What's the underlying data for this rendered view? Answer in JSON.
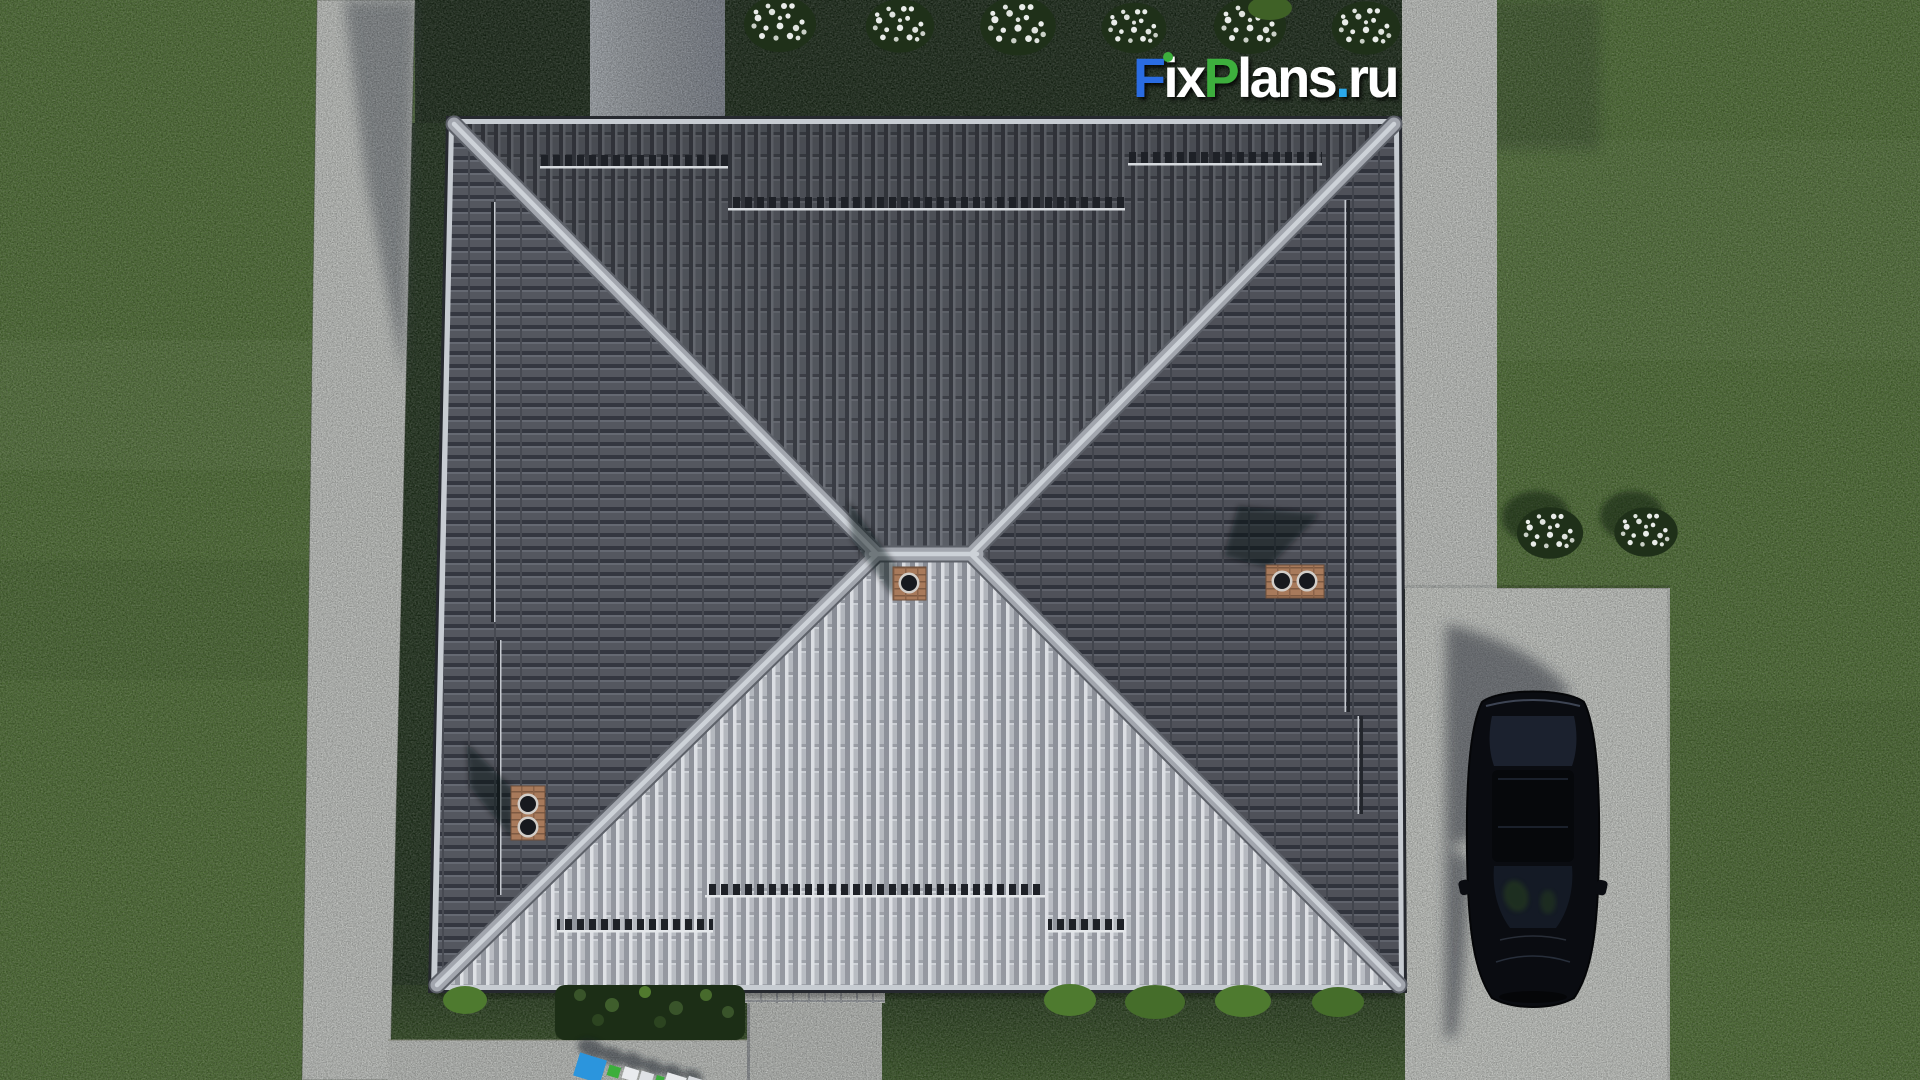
{
  "watermark": {
    "brand": "FixPlans.ru",
    "parts": [
      {
        "text": "F",
        "color": "#2a6ce2"
      },
      {
        "text": "ix",
        "color": "#ffffff"
      },
      {
        "text": "P",
        "color": "#3cae3c"
      },
      {
        "text": "lans",
        "color": "#ffffff"
      },
      {
        "text": ".",
        "color": "#2ba7ea"
      },
      {
        "text": "ru",
        "color": "#ffffff"
      }
    ]
  },
  "colors": {
    "lawn": "#4f7034",
    "lawn_shadow": "#1a2a18",
    "grass_side": "#20331c",
    "grass_bottom_top": "#273c1e",
    "grass_bottom_low": "#3c5a28",
    "concrete": "#c9ccc8",
    "concrete_shadow": "#aab0b6",
    "driveway": "#cdd0cb",
    "fascia": "#c7ccd2",
    "roof_north": "#5a5e66",
    "roof_south": "#b2b6bd",
    "roof_side": "#54575f",
    "ridge_cap": "#a2a6ae",
    "brick": "#a87a5b",
    "car_body": "#0a0c11",
    "flower_white": "#e9ece9",
    "bush_dark": "#1c2e16",
    "bush_light": "#4e7a2f",
    "logo_green": "#3cae3c"
  },
  "scene": {
    "view": "aerial-top-down-render",
    "objects": [
      "hip-roof-house",
      "roof-ridge-caps",
      "roof-snow-guards",
      "chimney-west",
      "chimney-center",
      "chimney-east",
      "black-car",
      "driveway",
      "left-sidewalk",
      "right-sidewalk",
      "back-sidewalk",
      "entrance-walkway",
      "front-stoop",
      "hedge-row",
      "flower-bushes-top",
      "flower-bushes-right",
      "lawn",
      "ground-watermark"
    ]
  }
}
